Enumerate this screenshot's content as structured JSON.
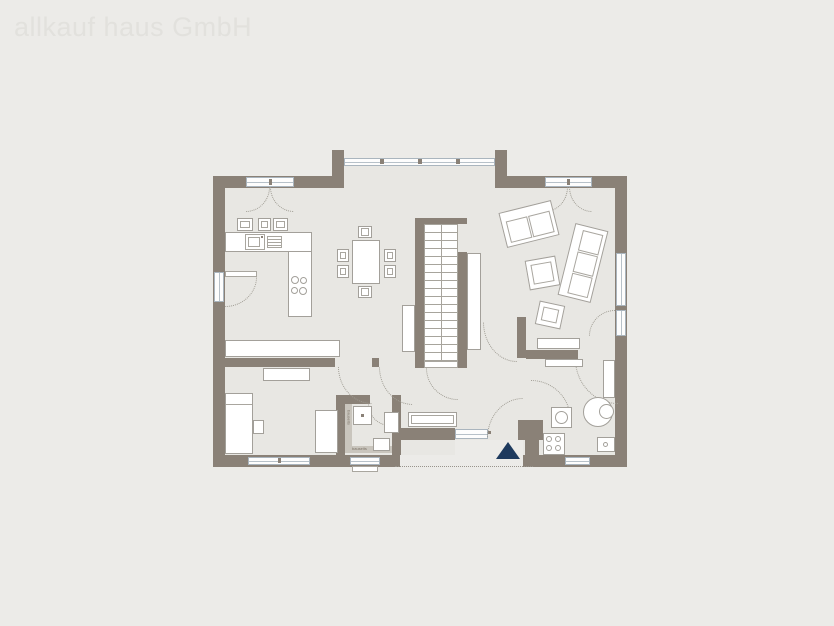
{
  "watermark": "allkauf haus GmbH",
  "plan": {
    "type": "floor-plan",
    "labels": {
      "bath_wall_vertical": "bauseits",
      "bath_wall_horizontal": "bauseits"
    }
  },
  "colors": {
    "background": "#ecebe8",
    "floor": "#e8e7e3",
    "wall": "#8a8177",
    "furniture_outline": "#a3a09a",
    "window_frame": "#aab5be",
    "door_swing": "#9f9c93",
    "entrance_marker": "#1e3a5e",
    "watermark_text": "#e2e1dd"
  }
}
